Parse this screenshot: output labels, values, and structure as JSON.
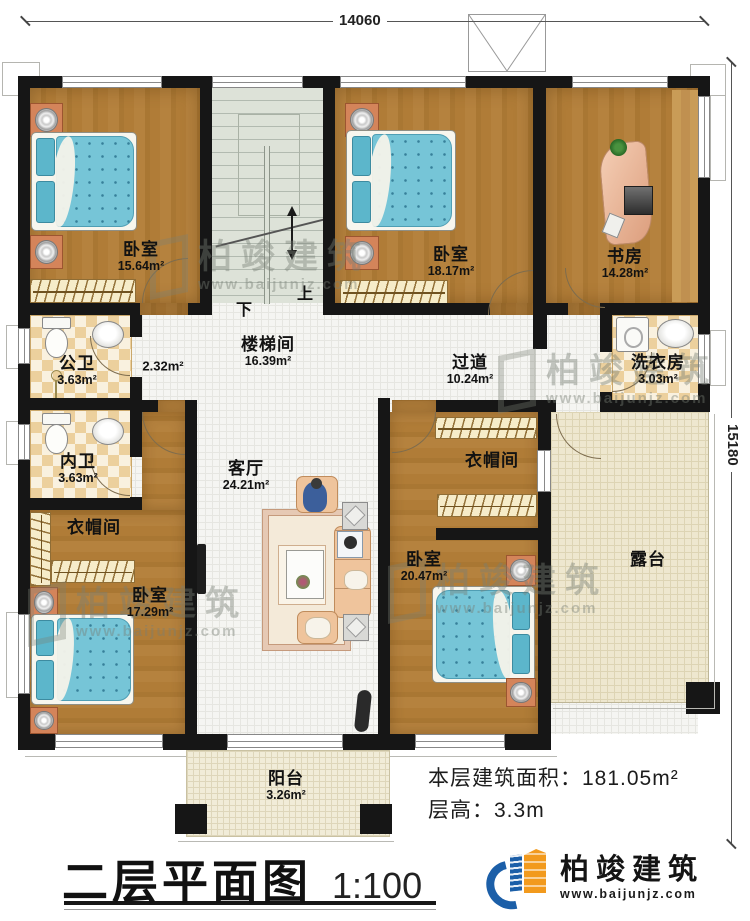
{
  "dims": {
    "top": "14060",
    "right": "15180"
  },
  "rooms": {
    "bedroom_tl": {
      "name": "卧室",
      "area": "15.64m²"
    },
    "stairwell": {
      "name": "楼梯间",
      "area": "16.39m²"
    },
    "bedroom_tm": {
      "name": "卧室",
      "area": "18.17m²"
    },
    "study": {
      "name": "书房",
      "area": "14.28m²"
    },
    "public_bath": {
      "name": "公卫",
      "area": "3.63m²"
    },
    "niche": {
      "area": "2.32m²"
    },
    "corridor": {
      "name": "过道",
      "area": "10.24m²"
    },
    "laundry": {
      "name": "洗衣房",
      "area": "3.03m²"
    },
    "private_bath": {
      "name": "内卫",
      "area": "3.63m²"
    },
    "living": {
      "name": "客厅",
      "area": "24.21m²"
    },
    "cloak_left": {
      "name": "衣帽间"
    },
    "cloak_right": {
      "name": "衣帽间"
    },
    "bedroom_bl": {
      "name": "卧室",
      "area": "17.29m²"
    },
    "bedroom_br": {
      "name": "卧室",
      "area": "20.47m²"
    },
    "terrace": {
      "name": "露台"
    },
    "balcony": {
      "name": "阳台",
      "area": "3.26m²"
    }
  },
  "stairs": {
    "up": "上",
    "down": "下"
  },
  "info": {
    "area_label": "本层建筑面积：",
    "area_value": "181.05m²",
    "height_label": "层高：",
    "height_value": "3.3m"
  },
  "title": {
    "text": "二层平面图",
    "scale": "1:100"
  },
  "brand": {
    "name": "柏竣建筑",
    "url": "www.baijunjz.com"
  },
  "watermark": {
    "name": "柏竣建筑",
    "url": "www.baijunjz.com"
  },
  "colors": {
    "wall": "#161616",
    "brand_blue": "#1c5fa8",
    "brand_orange": "#f29a1d"
  }
}
